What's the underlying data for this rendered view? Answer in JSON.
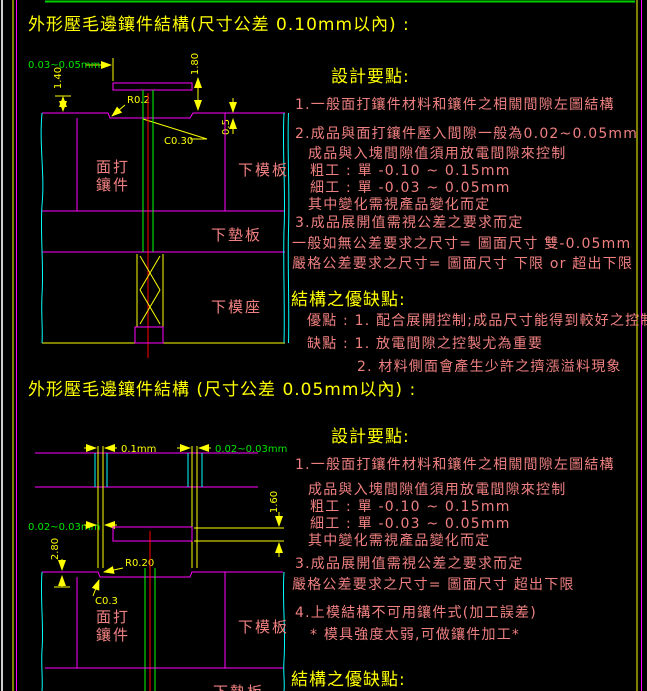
{
  "page": {
    "background": "#000000",
    "colors": {
      "line_magenta": "#ff00ff",
      "line_cyan": "#00ffff",
      "line_yellow": "#ffff00",
      "line_green": "#00ff00",
      "line_red": "#ff0000",
      "text_title_yellow": "#ffff00",
      "text_body_pink": "#f08080",
      "text_dim_green": "#00e600"
    }
  },
  "section1": {
    "title": "外形壓毛邊鑲件結構(尺寸公差 0.10mm以內) :",
    "design_heading": "設計要點:",
    "lines": {
      "l1": "1.一般面打鑲件材料和鑲件之相關間隙左圖結構",
      "l2": "2.成品與面打鑲件壓入間隙一般為0.02~0.05mm",
      "l3": "成品與入塊間隙值須用放電間隙來控制",
      "l4": "粗工 : 單 -0.10 ~ 0.15mm",
      "l5": "細工 : 單 -0.03 ~ 0.05mm",
      "l6": "其中變化需視產品變化而定",
      "l7": "3.成品展開值需視公差之要求而定",
      "l8": "一般如無公差要求之尺寸= 圖面尺寸 雙-0.05mm",
      "l9": "嚴格公差要求之尺寸= 圖面尺寸 下限 or 超出下限"
    },
    "pros_heading": "結構之優缺點:",
    "pros": {
      "p1": "優點 : 1. 配合展開控制;成品尺寸能得到較好之控制",
      "p2": "缺點 : 1. 放電間隙之控製尤為重要",
      "p3": "2. 材料側面會產生少許之擠漲溢料現象"
    },
    "diagram": {
      "dim_gap": "0.03~0.05mm",
      "dim_h1": "1.40",
      "dim_h2": "1.80",
      "dim_r": "R0.2",
      "dim_c": "C0.30",
      "dim_step": "0.5",
      "label_insert_1": "面打",
      "label_insert_2": "鑲件",
      "label_lower_plate": "下模板",
      "label_backing_plate": "下墊板",
      "label_die_holder": "下模座"
    }
  },
  "section2": {
    "title": "外形壓毛邊鑲件結構 (尺寸公差 0.05mm以內) :",
    "design_heading": "設計要點:",
    "lines": {
      "l1": "1.一般面打鑲件材料和鑲件之相關間隙左圖結構",
      "l2": "成品與入塊間隙值須用放電間隙來控制",
      "l3": "粗工 : 單 -0.10 ~ 0.15mm",
      "l4": "細工 : 單 -0.03 ~ 0.05mm",
      "l5": "其中變化需視產品變化而定",
      "l6": "3.成品展開值需視公差之要求而定",
      "l7": "嚴格公差要求之尺寸= 圖面尺寸  超出下限",
      "l8": "4.上模結構不可用鑲件式(加工誤差)",
      "l9": "* 模具強度太弱,可做鑲件加工*"
    },
    "pros_heading": "結構之優缺點:",
    "diagram": {
      "dim_slot": "0.1mm",
      "dim_gap_right": "0.02~0.03mm",
      "dim_gap_left": "0.02~0.03mm",
      "dim_h_right": "1.60",
      "dim_h_left": "2.80",
      "dim_r": "R0.20",
      "dim_c": "C0.3",
      "label_insert_1": "面打",
      "label_insert_2": "鑲件",
      "label_lower_plate": "下模板",
      "label_backing_plate": "下墊板"
    }
  }
}
